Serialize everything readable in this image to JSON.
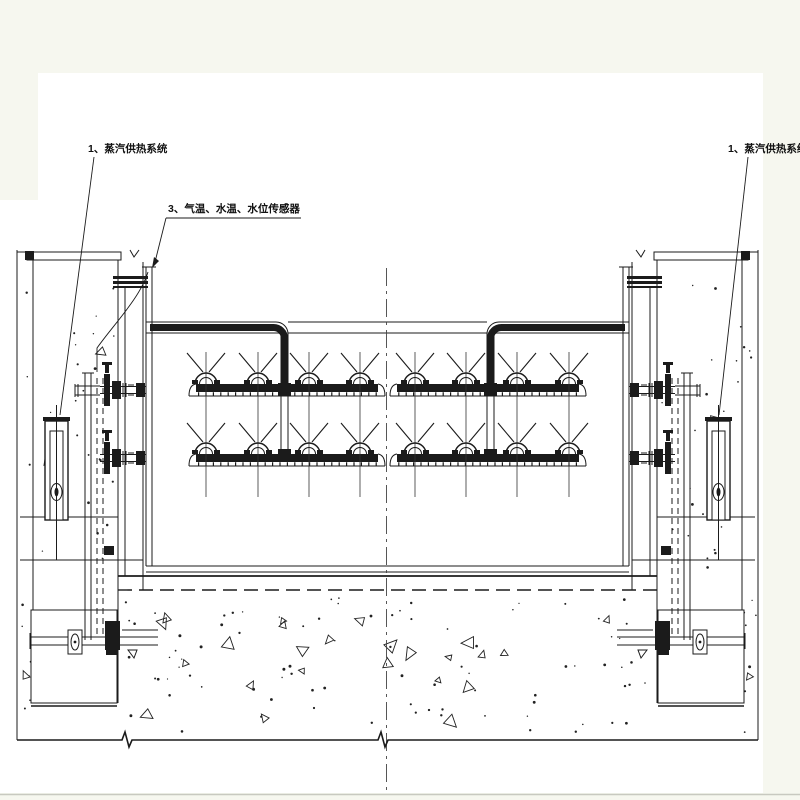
{
  "drawing": {
    "annotations": {
      "steam_system_left": "1、蒸汽供热系统",
      "sensors": "3、气温、水温、水位传感器",
      "steam_system_right": "1、蒸汽供热系统"
    },
    "colors": {
      "paper": "#ffffff",
      "margin": "#f6f7ef",
      "ink": "#1b1b1b"
    }
  }
}
